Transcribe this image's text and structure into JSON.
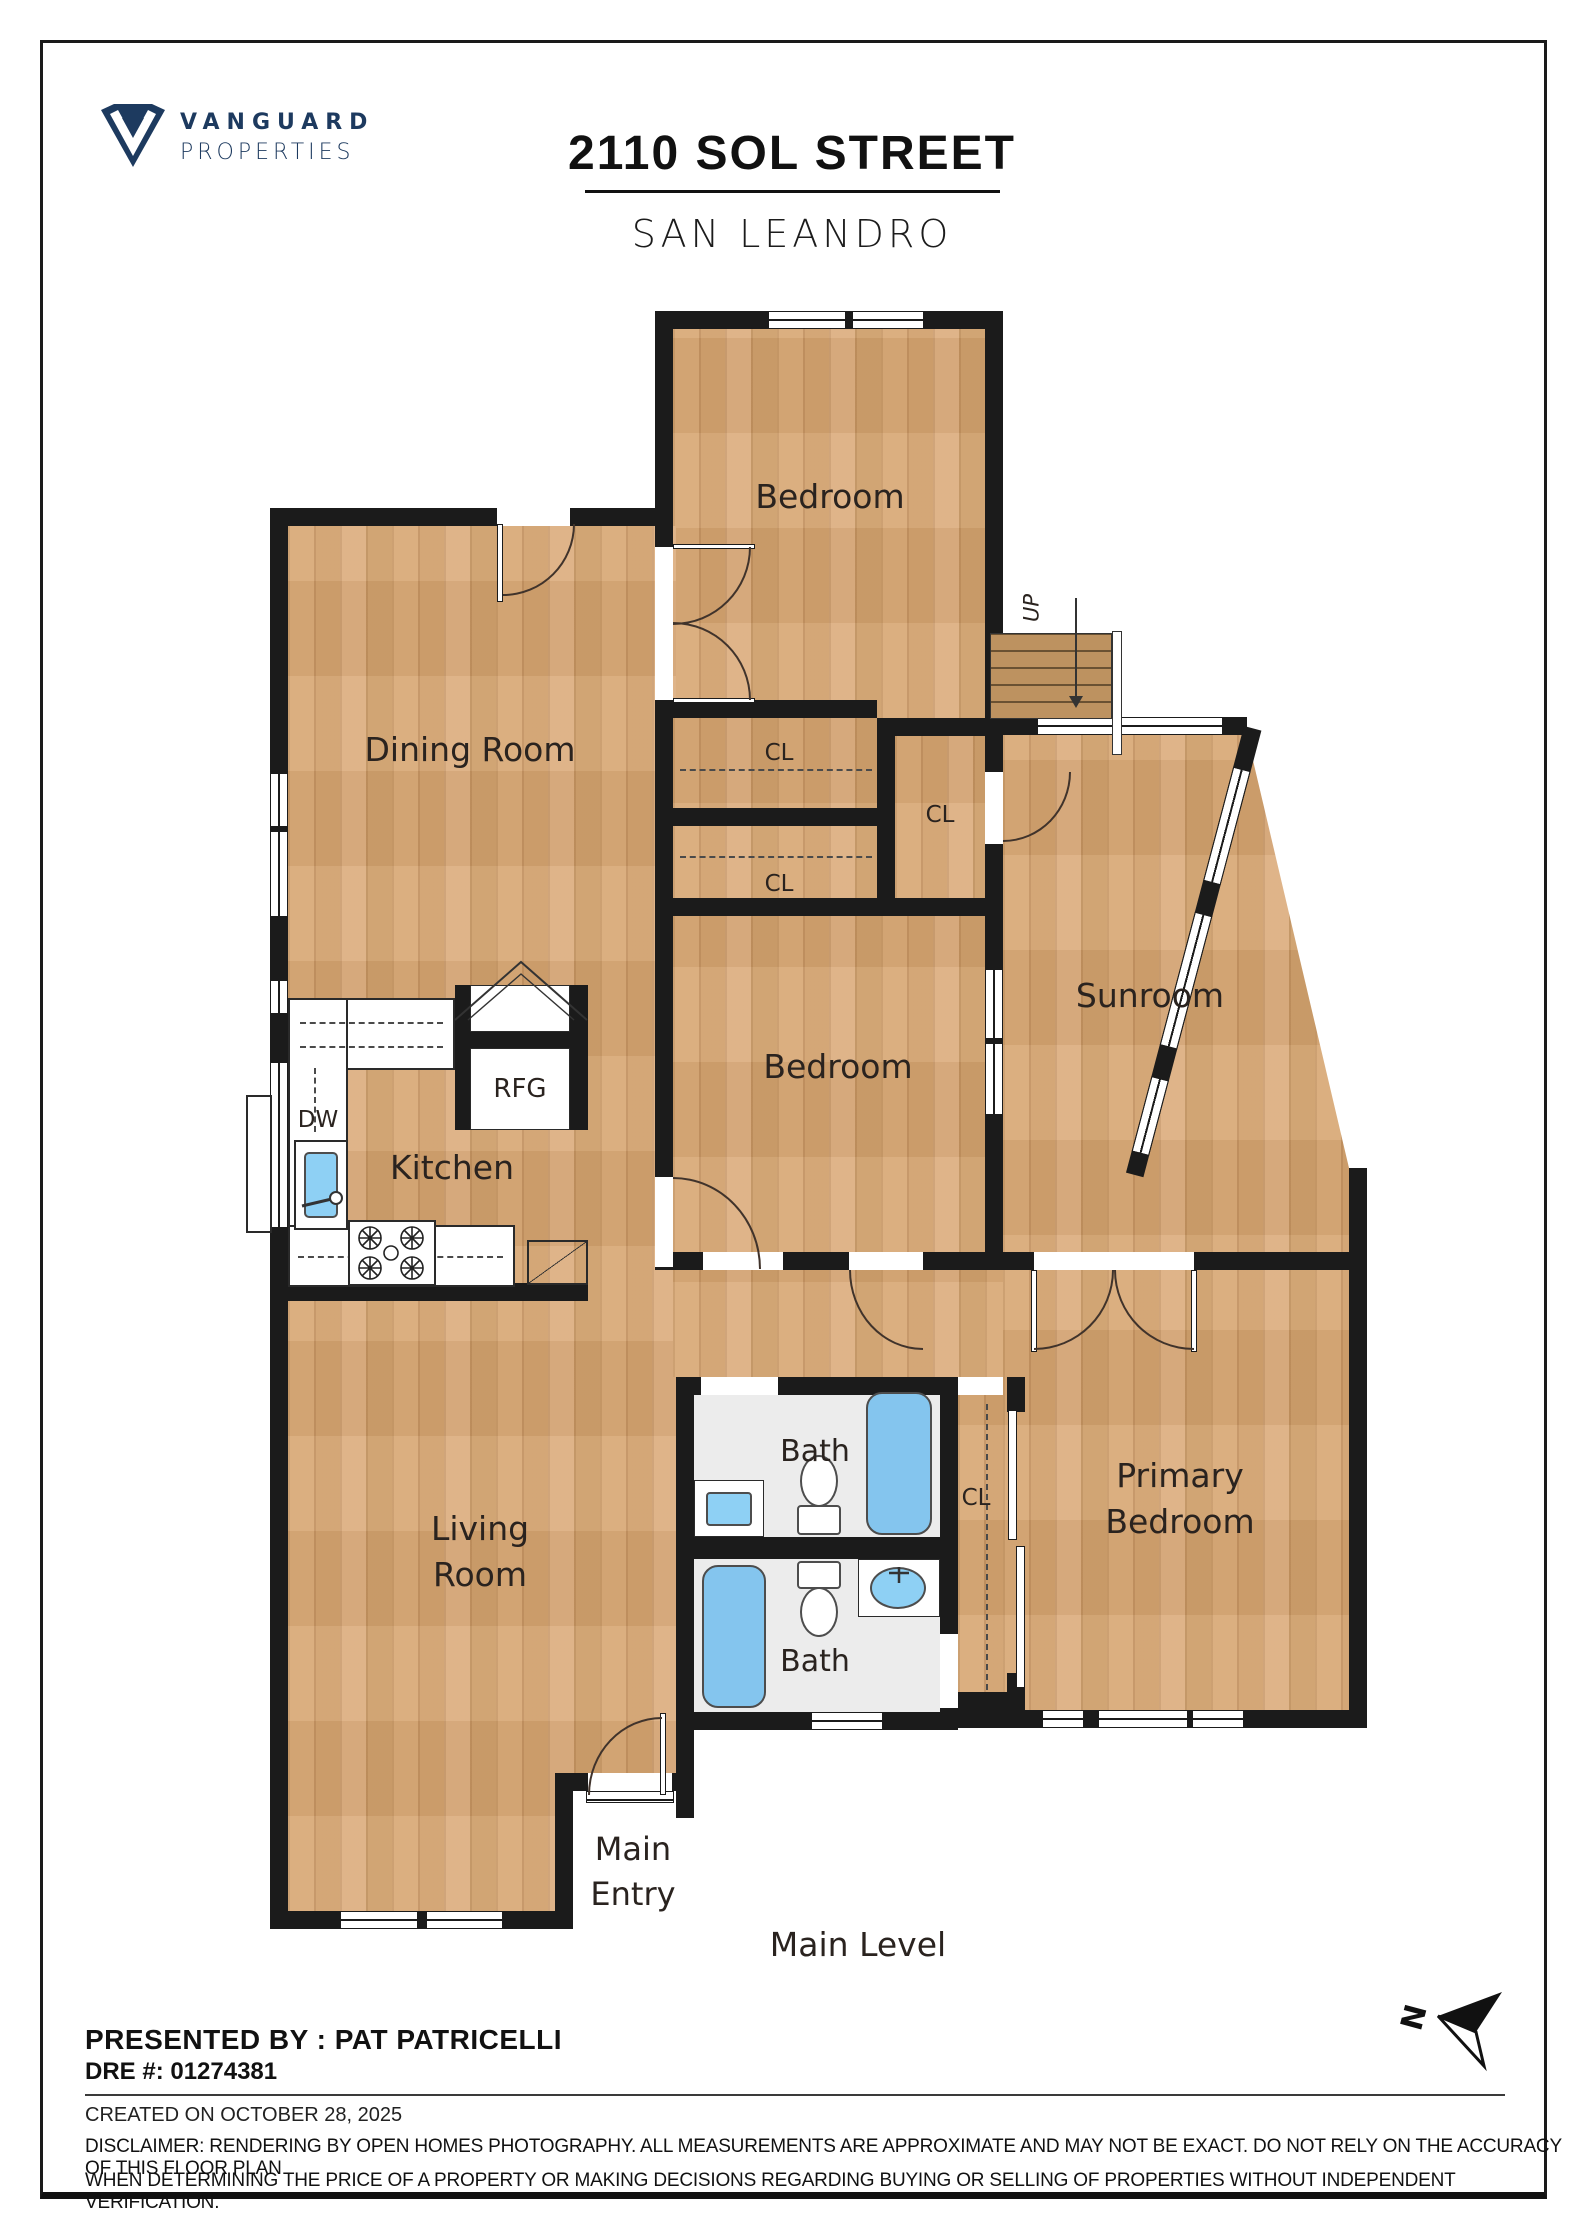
{
  "header": {
    "brand_line1": "VANGUARD",
    "brand_line2": "PROPERTIES",
    "title": "2110 SOL STREET",
    "subtitle": "SAN LEANDRO"
  },
  "floor_plan": {
    "level_label": "Main Level",
    "stairs_label": "UP",
    "compass_letter": "N",
    "rooms": {
      "bedroom_top": "Bedroom",
      "dining": "Dining Room",
      "sunroom": "Sunroom",
      "bedroom_mid": "Bedroom",
      "kitchen": "Kitchen",
      "living_line1": "Living",
      "living_line2": "Room",
      "primary_line1": "Primary",
      "primary_line2": "Bedroom",
      "bath_upper": "Bath",
      "bath_lower": "Bath",
      "entry_line1": "Main",
      "entry_line2": "Entry"
    },
    "closet_label": "CL",
    "appliances": {
      "refrigerator": "RFG",
      "dishwasher": "DW"
    }
  },
  "footer": {
    "presented_by": "PRESENTED BY : PAT PATRICELLI",
    "dre": "DRE #: 01274381",
    "created": "CREATED ON OCTOBER 28, 2025",
    "disclaimer_line1": "DISCLAIMER: RENDERING BY OPEN HOMES PHOTOGRAPHY. ALL MEASUREMENTS ARE APPROXIMATE AND MAY NOT BE EXACT. DO NOT RELY ON THE ACCURACY OF THIS FLOOR PLAN",
    "disclaimer_line2": "WHEN DETERMINING THE PRICE OF A PROPERTY OR MAKING DECISIONS REGARDING BUYING OR SELLING OF PROPERTIES WITHOUT INDEPENDENT VERIFICATION."
  },
  "colors": {
    "wall": "#1b1b1b",
    "wood": "#d6a876",
    "stair_wood": "#bd9260",
    "fixture_blue": "#84c5ee",
    "bath_floor": "#ececec",
    "brand_navy": "#1d3a5f"
  }
}
